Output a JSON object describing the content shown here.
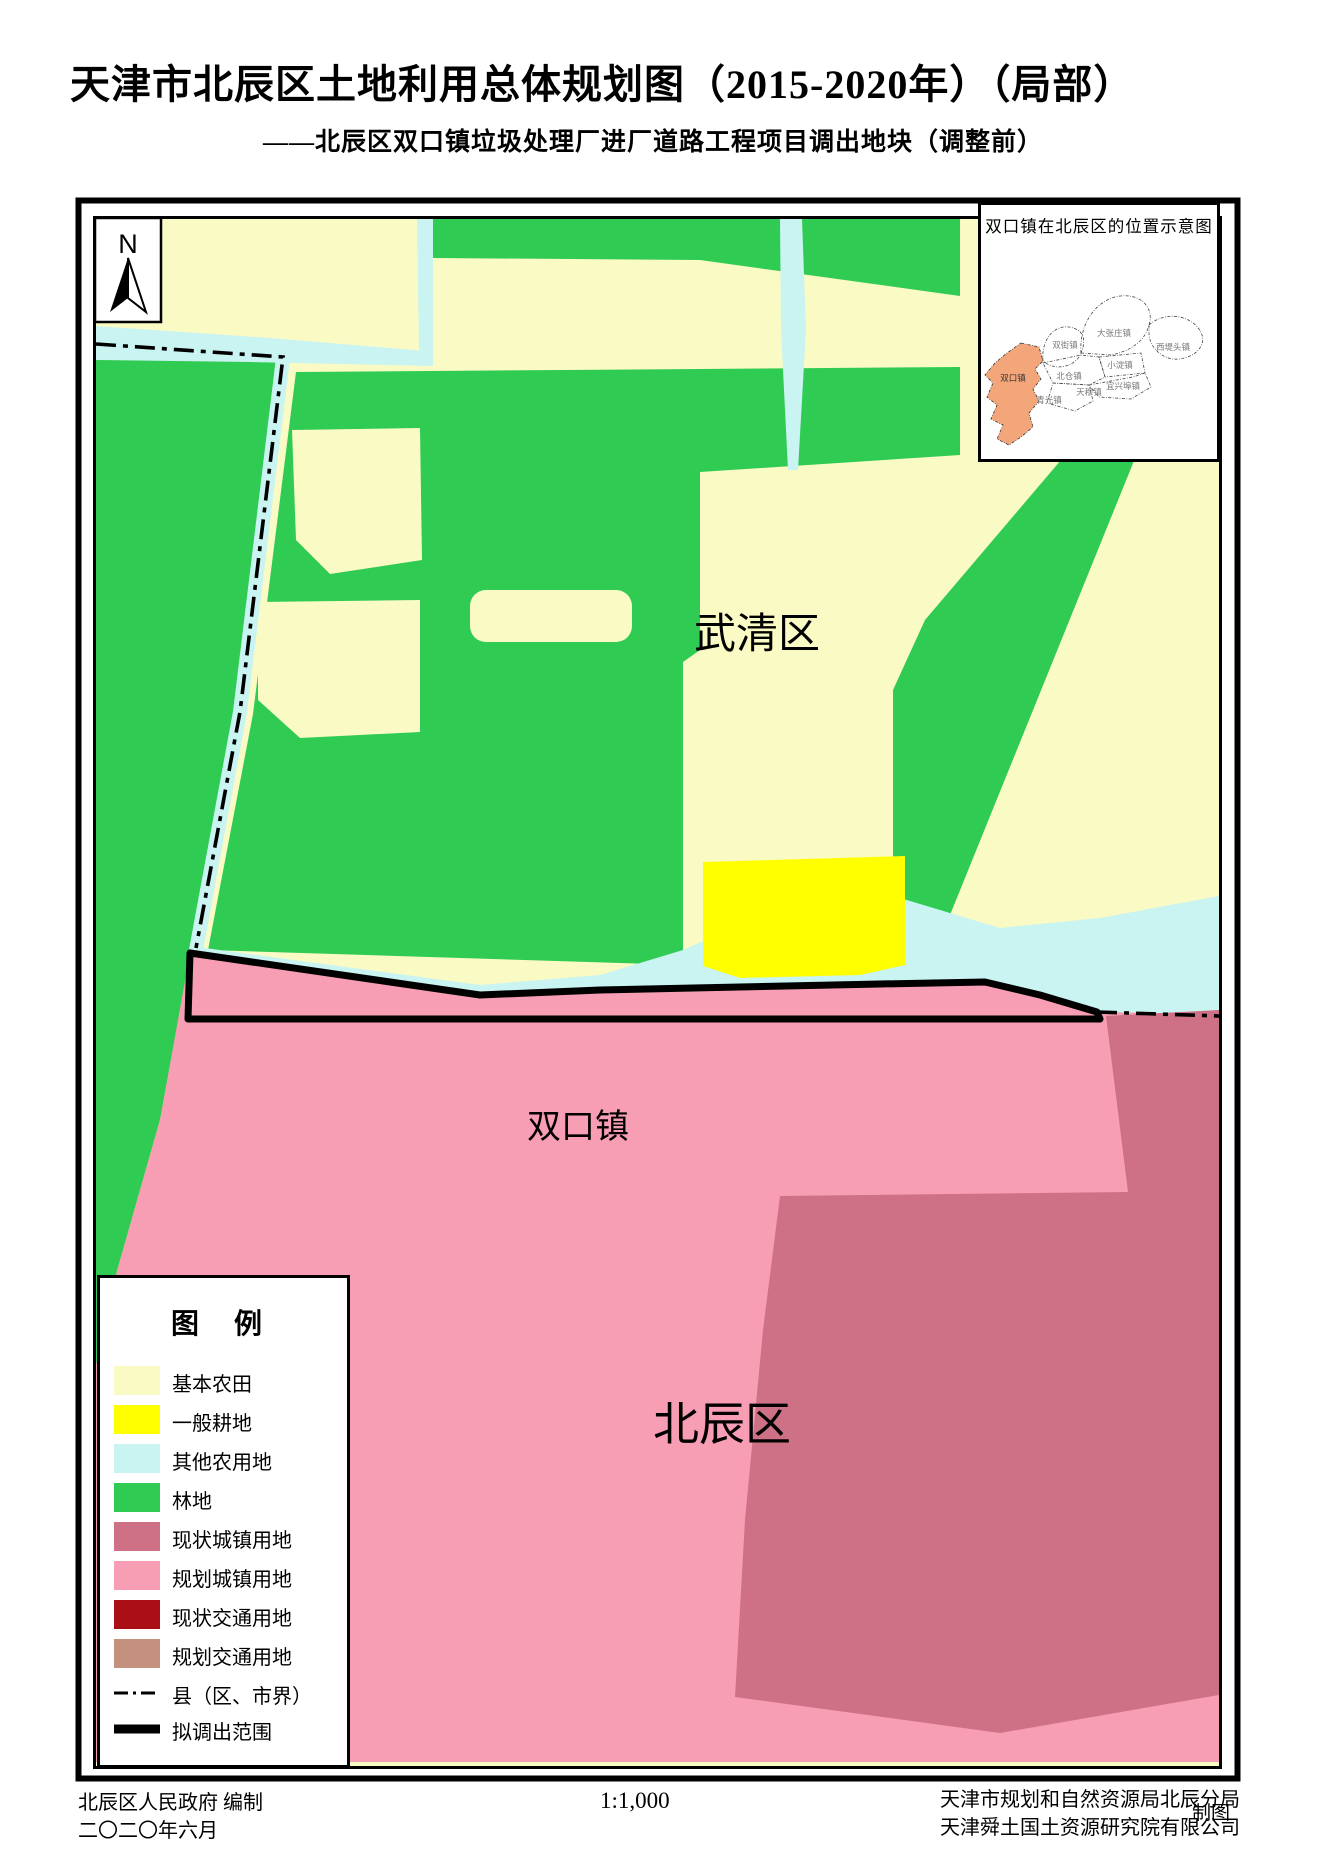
{
  "page": {
    "title": "天津市北辰区土地利用总体规划图（2015-2020年）（局部）",
    "subtitle": "——北辰区双口镇垃圾处理厂进厂道路工程项目调出地块（调整前）"
  },
  "colors": {
    "farmland": "#FAFAC5",
    "cropland": "#FFFF00",
    "other_agri": "#C9F4F2",
    "forest": "#2FCB53",
    "town_current": "#CE7187",
    "town_planned": "#F79DB4",
    "traffic_current": "#A90F15",
    "traffic_planned": "#C4917E",
    "boundary": "#000000",
    "inset_highlight": "#F2A679"
  },
  "map": {
    "north_label": "N",
    "labels": {
      "wuqing": "武清区",
      "shuangkou": "双口镇",
      "beichen": "北辰区"
    }
  },
  "inset": {
    "title": "双口镇在北辰区的位置示意图",
    "towns": [
      "双街镇",
      "大张庄镇",
      "西堤头镇",
      "小淀镇",
      "北仓镇",
      "宜兴埠镇",
      "天穆镇",
      "青光镇",
      "双口镇"
    ]
  },
  "legend": {
    "title": "图  例",
    "items": [
      {
        "label": "基本农田",
        "color": "#FAFAC5"
      },
      {
        "label": "一般耕地",
        "color": "#FFFF00"
      },
      {
        "label": "其他农用地",
        "color": "#C9F4F2"
      },
      {
        "label": "林地",
        "color": "#2FCB53"
      },
      {
        "label": "现状城镇用地",
        "color": "#CE7187"
      },
      {
        "label": "规划城镇用地",
        "color": "#F79DB4"
      },
      {
        "label": "现状交通用地",
        "color": "#A90F15"
      },
      {
        "label": "规划交通用地",
        "color": "#C4917E"
      },
      {
        "label": "县（区、市界）",
        "color": "#000000"
      },
      {
        "label": "拟调出范围",
        "color": "#000000"
      }
    ]
  },
  "footer": {
    "left1": "北辰区人民政府  编制",
    "left2": "二〇二〇年六月",
    "scale": "1:1,000",
    "right1": "天津市规划和自然资源局北辰分局",
    "right2": "天津舜土国土资源研究院有限公司",
    "right3": "制图"
  }
}
